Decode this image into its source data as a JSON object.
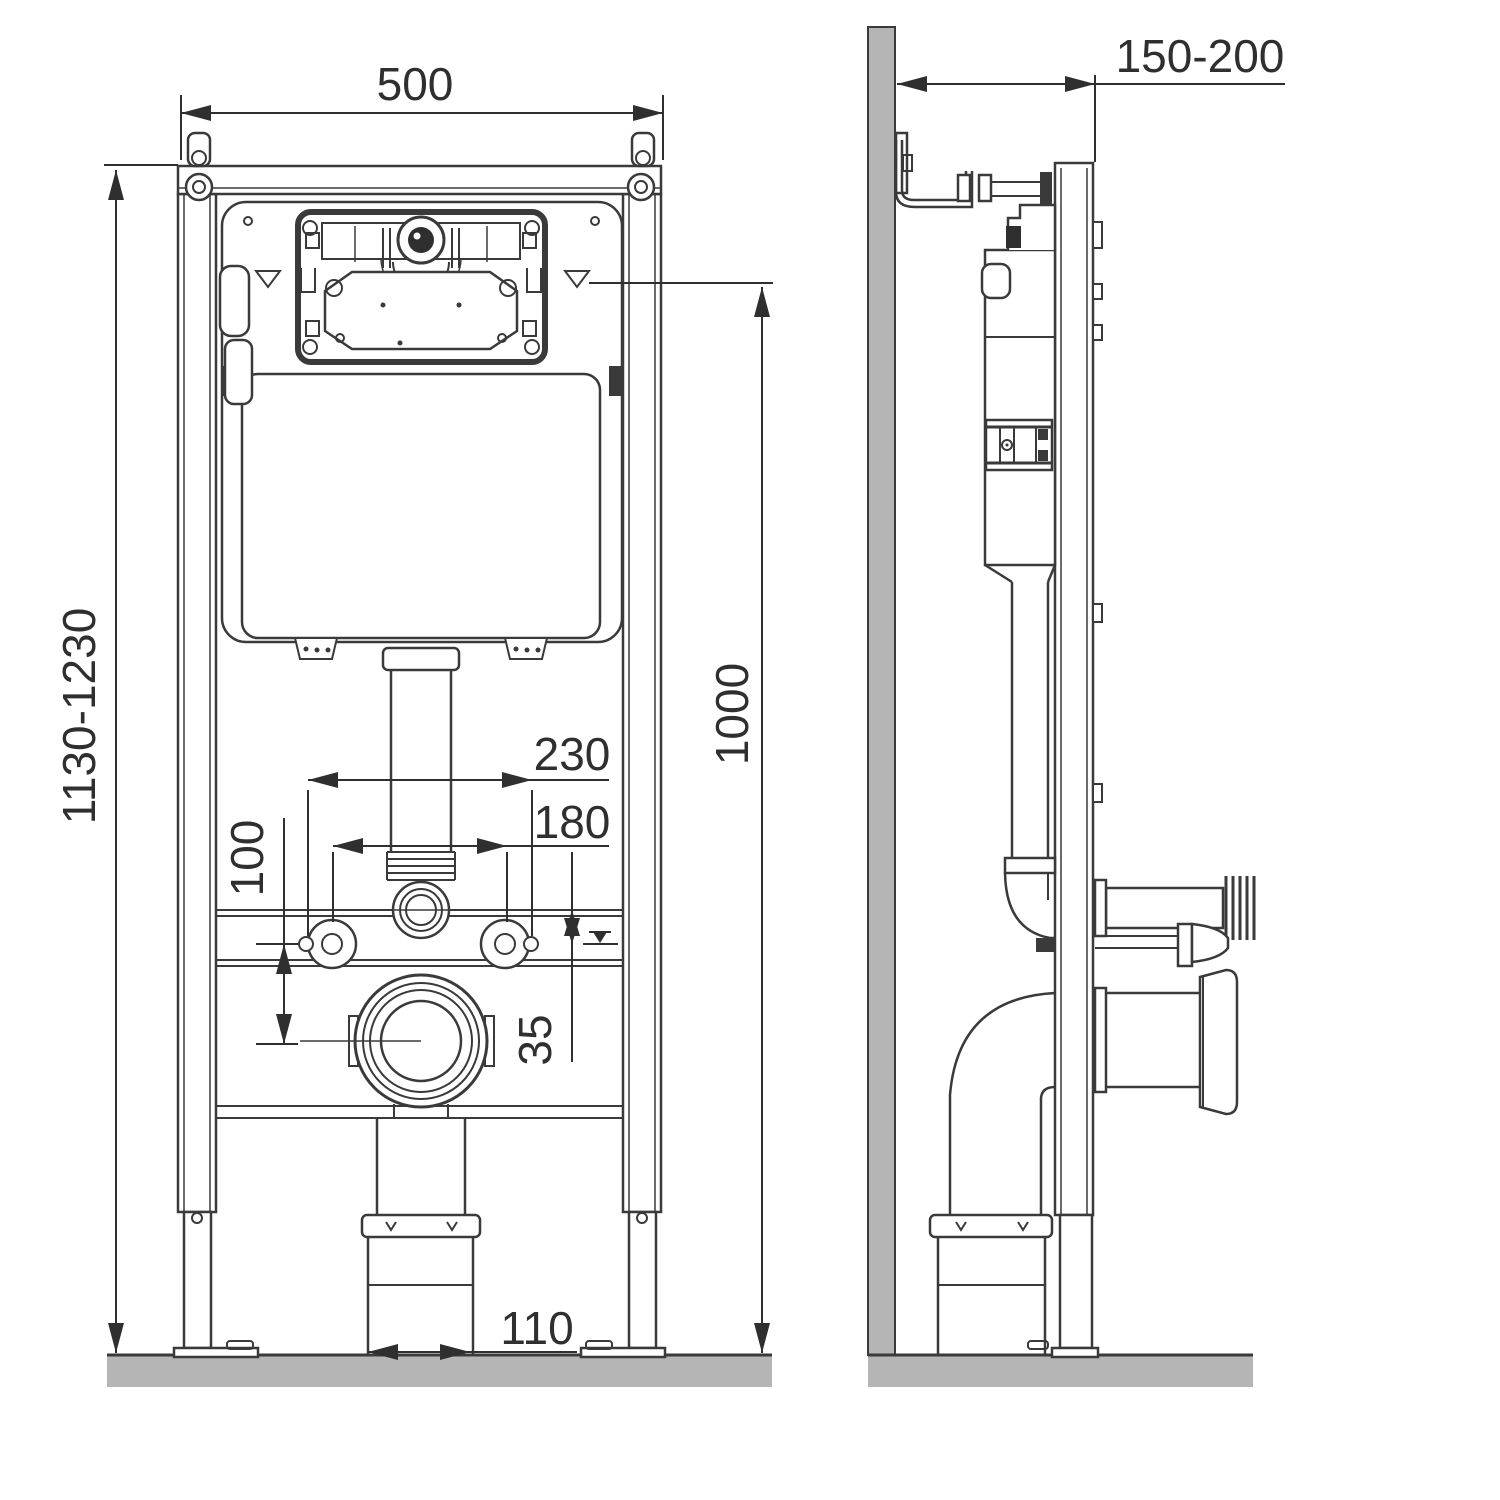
{
  "drawing": {
    "type": "technical-installation-diagram",
    "subject": "concealed WC cistern mounting frame, front and side views",
    "units_implied": "mm",
    "dimensions": {
      "frame_width": "500",
      "wall_offset": "150-200",
      "frame_height": "1130-1230",
      "flush_line_height": "1000",
      "stud_spacing": "230",
      "bolt_spacing": "180",
      "bolt_to_outlet": "100",
      "rail_to_bolt": "35",
      "outlet_diameter": "110"
    },
    "colors": {
      "line": "#3a3a3a",
      "dimension": "#2f2f2f",
      "wall_fill": "#b5b5b5",
      "background": "#ffffff"
    }
  }
}
